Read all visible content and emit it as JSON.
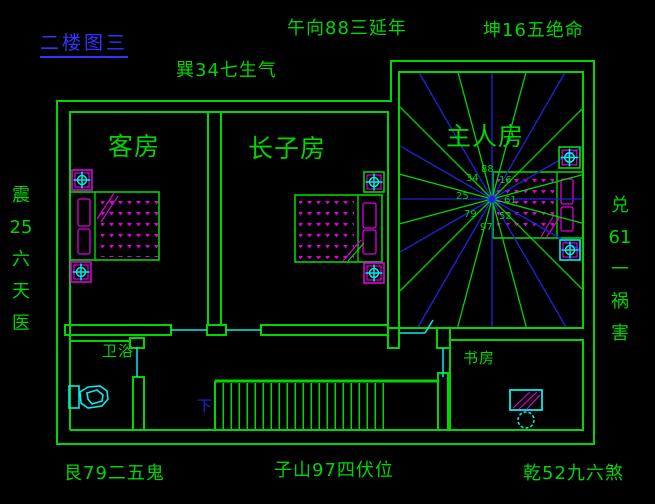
{
  "title": {
    "text": "二楼图三"
  },
  "compass": {
    "top_center": "午向88三延年",
    "top_right": "坤16五绝命",
    "upper_left": "巽34七生气",
    "left_chars": [
      "震",
      "25",
      "六",
      "天",
      "医"
    ],
    "right_chars": [
      "兑",
      "61",
      "一",
      "祸",
      "害"
    ],
    "bottom_left": "艮79二五鬼",
    "bottom_center": "子山97四伏位",
    "bottom_right": "乾52九六煞"
  },
  "rooms": {
    "guest": "客房",
    "eldest_son": "长子房",
    "master": "主人房",
    "bathroom": "卫浴",
    "study": "书房"
  },
  "stairs": {
    "down_label": "下"
  },
  "center_numbers": {
    "top_left": "34",
    "top": "88",
    "top_right": "16",
    "left": "25",
    "right": "61",
    "bottom_left": "79",
    "bottom_right": "52",
    "bottom": "97"
  },
  "icons": {
    "wall_light": "square-crosshair-lamp"
  },
  "colors": {
    "green": "#00d600",
    "blue": "#2222dd",
    "cyan": "#00eeee",
    "magenta": "#dd00dd",
    "title_blue": "#3333ff"
  }
}
